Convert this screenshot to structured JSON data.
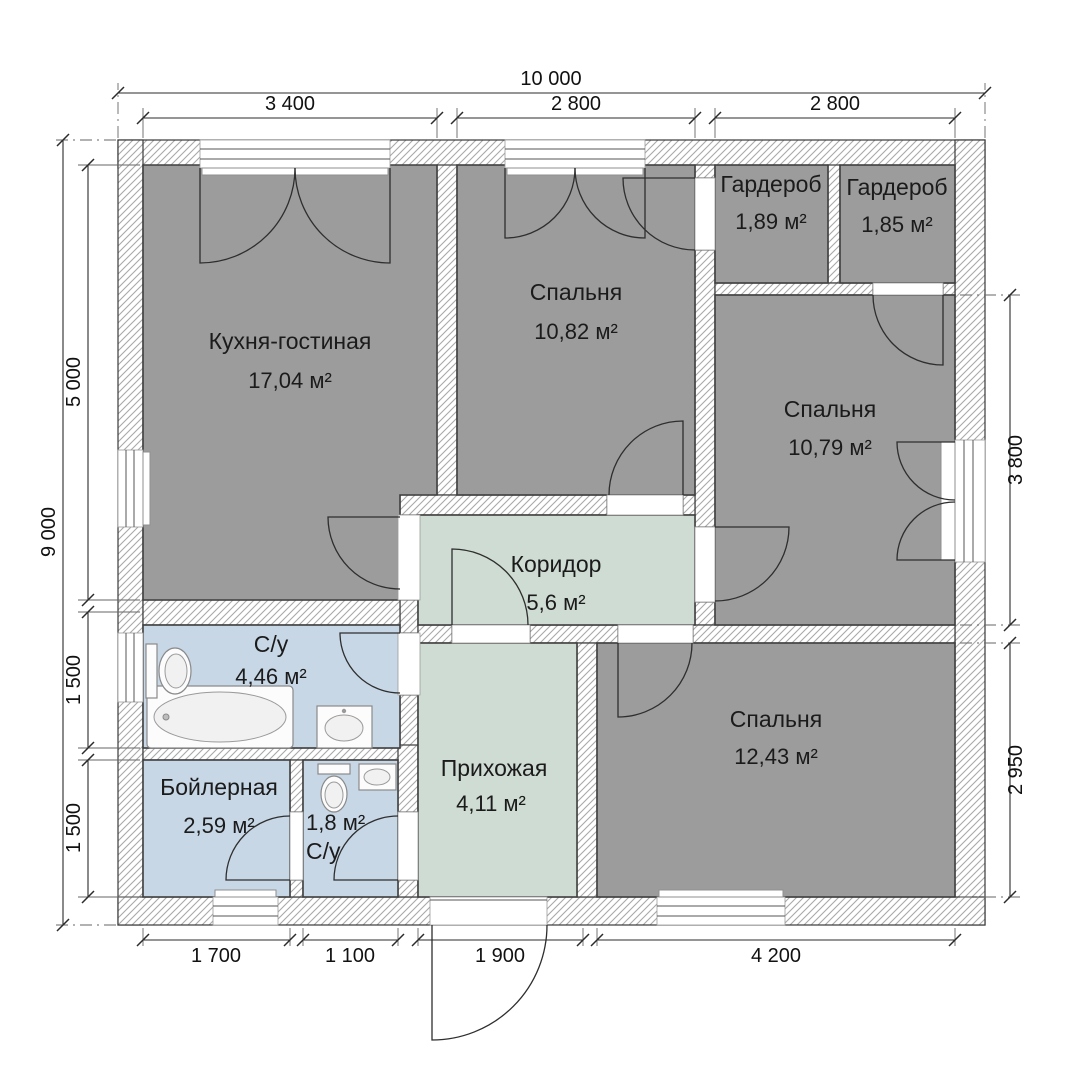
{
  "rooms": [
    {
      "id": "kitchen-living",
      "name": "Кухня-гостиная",
      "area": "17,04 м²"
    },
    {
      "id": "bedroom-top",
      "name": "Спальня",
      "area": "10,82 м²"
    },
    {
      "id": "wardrobe-left",
      "name": "Гардероб",
      "area": "1,89 м²"
    },
    {
      "id": "wardrobe-right",
      "name": "Гардероб",
      "area": "1,85 м²"
    },
    {
      "id": "bedroom-right",
      "name": "Спальня",
      "area": "10,79 м²"
    },
    {
      "id": "corridor",
      "name": "Коридор",
      "area": "5,6 м²"
    },
    {
      "id": "bathroom",
      "name": "С/у",
      "area": "4,46 м²"
    },
    {
      "id": "bedroom-bottom",
      "name": "Спальня",
      "area": "12,43 м²"
    },
    {
      "id": "boiler",
      "name": "Бойлерная",
      "area": "2,59 м²"
    },
    {
      "id": "wc",
      "name": "С/у",
      "area": "1,8 м²"
    },
    {
      "id": "hallway",
      "name": "Прихожая",
      "area": "4,11 м²"
    }
  ],
  "dimensions": {
    "top": {
      "overall": "10 000",
      "segments": [
        "3 400",
        "2 800",
        "2 800"
      ]
    },
    "left": {
      "overall": "9 000",
      "segments": [
        "5 000",
        "1 500",
        "1 500"
      ]
    },
    "right": {
      "segments": [
        "3 800",
        "2 950"
      ]
    },
    "bottom": {
      "segments": [
        "1 700",
        "1 100",
        "1 900",
        "4 200"
      ]
    }
  },
  "colors": {
    "room_gray": "#9c9c9c",
    "room_blue": "#c7d7e6",
    "room_green": "#cfdcd3",
    "wall_outline": "#3a3a3a",
    "dim_text": "#111111"
  }
}
